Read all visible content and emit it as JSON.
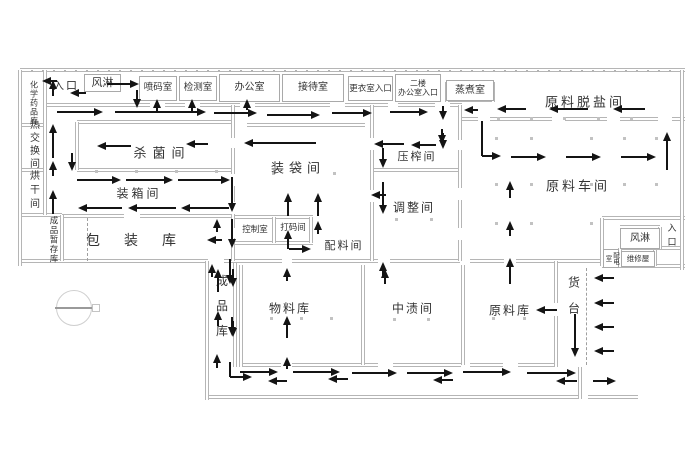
{
  "meta": {
    "bg": "#ffffff",
    "wall_color": "#b5b5b5",
    "arrow_color": "#141414",
    "text_color": "#333333",
    "canvas_width": 700,
    "canvas_height": 466
  },
  "floorplan": {
    "boxed_rooms": [
      {
        "id": "air-shower-top",
        "label": "风淋",
        "x": 84,
        "y": 74,
        "w": 37,
        "h": 18,
        "fs": 11
      },
      {
        "id": "code-spray-room",
        "label": "喷码室",
        "x": 139,
        "y": 76,
        "w": 38,
        "h": 25,
        "fs": 9.5
      },
      {
        "id": "inspection-room",
        "label": "检测室",
        "x": 179,
        "y": 76,
        "w": 38,
        "h": 25,
        "fs": 9.5
      },
      {
        "id": "office",
        "label": "办公室",
        "x": 219,
        "y": 74,
        "w": 61,
        "h": 28,
        "fs": 10
      },
      {
        "id": "reception-room",
        "label": "接待室",
        "x": 282,
        "y": 74,
        "w": 62,
        "h": 28,
        "fs": 10
      },
      {
        "id": "changing-room-entrance",
        "label": "更衣室入口",
        "x": 348,
        "y": 76,
        "w": 45,
        "h": 25,
        "fs": 8.5
      },
      {
        "id": "second-floor-office-entrance",
        "label": "二楼\n办公室入口",
        "x": 395,
        "y": 74,
        "w": 46,
        "h": 28,
        "fs": 8
      },
      {
        "id": "steaming-room",
        "label": "蒸煮室",
        "x": 446,
        "y": 80,
        "w": 48,
        "h": 21,
        "fs": 10
      },
      {
        "id": "air-shower-right",
        "label": "风淋",
        "x": 620,
        "y": 228,
        "w": 40,
        "h": 21,
        "fs": 10
      },
      {
        "id": "power-distribution-room",
        "label": "配电室",
        "x": 603,
        "y": 249,
        "w": 16,
        "h": 19,
        "fs": 6.5,
        "v": true
      },
      {
        "id": "maintenance-room",
        "label": "维修屋",
        "x": 621,
        "y": 251,
        "w": 34,
        "h": 16,
        "fs": 7.5
      }
    ],
    "labels": [
      {
        "id": "entrance-left",
        "label": "入口",
        "x": 66,
        "y": 85,
        "fs": 11,
        "ls": 2
      },
      {
        "id": "chemical-storage",
        "label": "化学药品库",
        "x": 34,
        "y": 103,
        "fs": 8,
        "ls": 1,
        "v": true
      },
      {
        "id": "heat-exchange-room",
        "label": "热交换间",
        "x": 33,
        "y": 145,
        "fs": 10,
        "ls": 3,
        "v": true
      },
      {
        "id": "drying-room",
        "label": "烘干间",
        "x": 33,
        "y": 191,
        "fs": 10,
        "ls": 4,
        "v": true
      },
      {
        "id": "finished-goods-temp-storage",
        "label": "成品暂存库",
        "x": 54,
        "y": 240,
        "fs": 8.5,
        "ls": 1,
        "v": true
      },
      {
        "id": "sterilization-room",
        "label": "杀菌间",
        "x": 162,
        "y": 152,
        "fs": 13,
        "ls": 6
      },
      {
        "id": "packing-box-room",
        "label": "装箱间",
        "x": 139,
        "y": 193,
        "fs": 12,
        "ls": 3
      },
      {
        "id": "packaging-warehouse",
        "label": "包装库",
        "x": 143,
        "y": 240,
        "fs": 14,
        "ls": 24
      },
      {
        "id": "bagging-room",
        "label": "装袋间",
        "x": 298,
        "y": 167,
        "fs": 13,
        "ls": 5
      },
      {
        "id": "control-room",
        "label": "控制室",
        "x": 255,
        "y": 229,
        "fs": 8.5,
        "ls": 0
      },
      {
        "id": "code-printing-room",
        "label": "打码间",
        "x": 293,
        "y": 227,
        "fs": 8.5,
        "ls": 0
      },
      {
        "id": "ingredients-room",
        "label": "配料间",
        "x": 344,
        "y": 245,
        "fs": 11,
        "ls": 2
      },
      {
        "id": "pressing-room",
        "label": "压榨间",
        "x": 417,
        "y": 156,
        "fs": 11,
        "ls": 2
      },
      {
        "id": "adjustment-room",
        "label": "调整间",
        "x": 414,
        "y": 207,
        "fs": 12,
        "ls": 2
      },
      {
        "id": "raw-material-desalting-room",
        "label": "原料脱盐间",
        "x": 585,
        "y": 101,
        "fs": 13,
        "ls": 3
      },
      {
        "id": "raw-material-workshop",
        "label": "原料车间",
        "x": 578,
        "y": 185,
        "fs": 13,
        "ls": 3
      },
      {
        "id": "entrance-right",
        "label": "入口",
        "x": 672,
        "y": 237,
        "fs": 9,
        "ls": 5,
        "v": true
      },
      {
        "id": "finished-goods-warehouse",
        "label": "成品库",
        "x": 222,
        "y": 312,
        "fs": 12,
        "ls": 13,
        "v": true
      },
      {
        "id": "material-warehouse",
        "label": "物料库",
        "x": 290,
        "y": 308,
        "fs": 12,
        "ls": 2
      },
      {
        "id": "mid-pickling-room",
        "label": "中渍间",
        "x": 413,
        "y": 308,
        "fs": 12,
        "ls": 2
      },
      {
        "id": "raw-material-warehouse",
        "label": "原料库",
        "x": 510,
        "y": 310,
        "fs": 12,
        "ls": 2
      },
      {
        "id": "loading-dock",
        "label": "货台",
        "x": 574,
        "y": 302,
        "fs": 12,
        "ls": 14,
        "v": true
      }
    ],
    "walls": [
      [
        20,
        70,
        665,
        "h",
        "hatch"
      ],
      [
        45,
        105,
        105,
        "h"
      ],
      [
        165,
        105,
        20,
        "h"
      ],
      [
        200,
        105,
        40,
        "h"
      ],
      [
        255,
        105,
        75,
        "h"
      ],
      [
        345,
        105,
        43,
        "h"
      ],
      [
        398,
        105,
        37,
        "h"
      ],
      [
        450,
        105,
        12,
        "h"
      ],
      [
        20,
        125,
        25,
        "h"
      ],
      [
        20,
        170,
        25,
        "h"
      ],
      [
        20,
        215,
        42,
        "h"
      ],
      [
        77,
        122,
        158,
        "h"
      ],
      [
        77,
        170,
        158,
        "h"
      ],
      [
        62,
        216,
        62,
        "h"
      ],
      [
        140,
        216,
        95,
        "h"
      ],
      [
        247,
        125,
        118,
        "h"
      ],
      [
        235,
        217,
        78,
        "h"
      ],
      [
        235,
        243,
        78,
        "h"
      ],
      [
        374,
        170,
        86,
        "h"
      ],
      [
        447,
        100,
        48,
        "h"
      ],
      [
        460,
        119,
        18,
        "h"
      ],
      [
        490,
        119,
        62,
        "h"
      ],
      [
        565,
        119,
        42,
        "h"
      ],
      [
        620,
        119,
        38,
        "h"
      ],
      [
        672,
        119,
        13,
        "h"
      ],
      [
        602,
        218,
        83,
        "h"
      ],
      [
        602,
        266,
        83,
        "h"
      ],
      [
        620,
        227,
        40,
        "h"
      ],
      [
        620,
        248,
        63,
        "h"
      ],
      [
        20,
        261,
        188,
        "h"
      ],
      [
        224,
        261,
        58,
        "h"
      ],
      [
        292,
        261,
        86,
        "h"
      ],
      [
        390,
        261,
        70,
        "h"
      ],
      [
        470,
        261,
        34,
        "h"
      ],
      [
        516,
        261,
        86,
        "h"
      ],
      [
        241,
        365,
        40,
        "h"
      ],
      [
        292,
        365,
        86,
        "h"
      ],
      [
        393,
        365,
        68,
        "h"
      ],
      [
        470,
        365,
        33,
        "h"
      ],
      [
        518,
        365,
        38,
        "h"
      ],
      [
        207,
        397,
        373,
        "h"
      ],
      [
        588,
        397,
        50,
        "h"
      ],
      [
        20,
        70,
        196,
        "v"
      ],
      [
        682,
        70,
        200,
        "v"
      ],
      [
        45,
        70,
        145,
        "v"
      ],
      [
        62,
        215,
        46,
        "v"
      ],
      [
        77,
        122,
        48,
        "v"
      ],
      [
        233,
        105,
        33,
        "v"
      ],
      [
        233,
        148,
        26,
        "v"
      ],
      [
        233,
        186,
        16,
        "v"
      ],
      [
        233,
        214,
        14,
        "v"
      ],
      [
        233,
        238,
        23,
        "v"
      ],
      [
        274,
        217,
        26,
        "v"
      ],
      [
        311,
        217,
        26,
        "v"
      ],
      [
        372,
        105,
        33,
        "v"
      ],
      [
        372,
        150,
        40,
        "v"
      ],
      [
        372,
        202,
        59,
        "v"
      ],
      [
        460,
        105,
        35,
        "v"
      ],
      [
        460,
        150,
        38,
        "v"
      ],
      [
        460,
        200,
        28,
        "v"
      ],
      [
        460,
        240,
        21,
        "v"
      ],
      [
        447,
        82,
        20,
        "v"
      ],
      [
        493,
        82,
        20,
        "v"
      ],
      [
        602,
        218,
        48,
        "v"
      ],
      [
        660,
        227,
        22,
        "v"
      ],
      [
        620,
        248,
        18,
        "v"
      ],
      [
        655,
        250,
        16,
        "v"
      ],
      [
        207,
        261,
        139,
        "v"
      ],
      [
        235,
        263,
        104,
        "v"
      ],
      [
        241,
        265,
        102,
        "v"
      ],
      [
        363,
        265,
        100,
        "v"
      ],
      [
        463,
        265,
        100,
        "v"
      ],
      [
        556,
        261,
        42,
        "v"
      ],
      [
        556,
        316,
        51,
        "v"
      ],
      [
        580,
        367,
        32,
        "v"
      ],
      [
        588,
        268,
        97,
        "v",
        "dashed"
      ],
      [
        89,
        218,
        43,
        "v",
        "dashed"
      ]
    ],
    "arrows": [
      [
        53,
        96,
        53,
        80
      ],
      [
        57,
        81,
        42,
        81
      ],
      [
        86,
        93,
        70,
        93
      ],
      [
        107,
        84,
        139,
        84
      ],
      [
        137,
        90,
        137,
        108
      ],
      [
        57,
        112,
        103,
        112
      ],
      [
        115,
        112,
        206,
        112
      ],
      [
        157,
        111,
        157,
        99
      ],
      [
        192,
        111,
        192,
        99
      ],
      [
        214,
        113,
        257,
        113
      ],
      [
        247,
        110,
        247,
        99
      ],
      [
        267,
        115,
        320,
        115
      ],
      [
        332,
        113,
        372,
        113
      ],
      [
        390,
        112,
        428,
        112
      ],
      [
        443,
        106,
        443,
        120
      ],
      [
        478,
        110,
        464,
        110
      ],
      [
        443,
        133,
        443,
        149
      ],
      [
        526,
        109,
        497,
        109
      ],
      [
        588,
        109,
        549,
        109
      ],
      [
        645,
        109,
        613,
        109
      ],
      [
        667,
        170,
        667,
        132
      ],
      [
        482,
        121,
        482,
        156,
        "s"
      ],
      [
        482,
        156,
        501,
        156
      ],
      [
        511,
        157,
        546,
        157
      ],
      [
        566,
        157,
        601,
        157
      ],
      [
        621,
        157,
        656,
        157
      ],
      [
        510,
        198,
        510,
        181
      ],
      [
        510,
        236,
        510,
        221
      ],
      [
        510,
        284,
        510,
        258
      ],
      [
        442,
        129,
        442,
        144
      ],
      [
        436,
        145,
        411,
        145
      ],
      [
        404,
        144,
        374,
        144
      ],
      [
        383,
        148,
        383,
        168
      ],
      [
        386,
        195,
        371,
        195
      ],
      [
        383,
        182,
        383,
        214
      ],
      [
        383,
        277,
        383,
        262
      ],
      [
        316,
        143,
        244,
        143
      ],
      [
        288,
        216,
        288,
        193
      ],
      [
        318,
        216,
        318,
        193
      ],
      [
        318,
        234,
        318,
        221
      ],
      [
        288,
        249,
        288,
        230
      ],
      [
        289,
        249,
        311,
        249
      ],
      [
        131,
        146,
        97,
        146
      ],
      [
        208,
        144,
        186,
        144
      ],
      [
        53,
        158,
        53,
        124
      ],
      [
        53,
        176,
        53,
        161
      ],
      [
        72,
        153,
        72,
        171
      ],
      [
        53,
        214,
        53,
        190
      ],
      [
        77,
        180,
        121,
        180
      ],
      [
        126,
        180,
        173,
        180
      ],
      [
        178,
        180,
        230,
        180
      ],
      [
        122,
        208,
        78,
        208
      ],
      [
        176,
        208,
        128,
        208
      ],
      [
        229,
        208,
        181,
        208
      ],
      [
        232,
        177,
        232,
        212
      ],
      [
        217,
        232,
        217,
        219
      ],
      [
        222,
        240,
        207,
        240
      ],
      [
        232,
        219,
        232,
        248
      ],
      [
        212,
        277,
        212,
        264
      ],
      [
        218,
        292,
        218,
        269
      ],
      [
        230,
        259,
        230,
        284
      ],
      [
        218,
        326,
        218,
        311
      ],
      [
        232,
        317,
        232,
        336
      ],
      [
        217,
        368,
        217,
        354
      ],
      [
        230,
        362,
        230,
        377,
        "s"
      ],
      [
        230,
        377,
        252,
        377
      ],
      [
        240,
        372,
        278,
        372
      ],
      [
        287,
        369,
        287,
        357
      ],
      [
        287,
        381,
        268,
        381
      ],
      [
        293,
        372,
        340,
        372
      ],
      [
        348,
        379,
        328,
        379
      ],
      [
        352,
        373,
        397,
        373
      ],
      [
        407,
        373,
        453,
        373
      ],
      [
        453,
        380,
        433,
        380
      ],
      [
        463,
        372,
        511,
        372
      ],
      [
        527,
        373,
        576,
        373
      ],
      [
        577,
        381,
        556,
        381
      ],
      [
        593,
        381,
        616,
        381
      ],
      [
        287,
        281,
        287,
        268
      ],
      [
        287,
        338,
        287,
        316
      ],
      [
        385,
        284,
        385,
        269
      ],
      [
        233,
        269,
        233,
        287
      ],
      [
        233,
        321,
        233,
        337
      ],
      [
        557,
        310,
        536,
        310
      ],
      [
        575,
        314,
        575,
        357
      ],
      [
        614,
        278,
        594,
        278
      ],
      [
        614,
        303,
        594,
        303
      ],
      [
        614,
        327,
        594,
        327
      ],
      [
        614,
        351,
        594,
        351
      ]
    ],
    "dots": [
      [
        95,
        170
      ],
      [
        135,
        170
      ],
      [
        175,
        170
      ],
      [
        215,
        170
      ],
      [
        272,
        172
      ],
      [
        333,
        172
      ],
      [
        395,
        218
      ],
      [
        430,
        218
      ],
      [
        497,
        117
      ],
      [
        530,
        117
      ],
      [
        563,
        117
      ],
      [
        597,
        117
      ],
      [
        630,
        117
      ],
      [
        495,
        137
      ],
      [
        530,
        137
      ],
      [
        590,
        137
      ],
      [
        623,
        137
      ],
      [
        655,
        137
      ],
      [
        495,
        183
      ],
      [
        530,
        183
      ],
      [
        590,
        183
      ],
      [
        623,
        183
      ],
      [
        655,
        183
      ],
      [
        495,
        222
      ],
      [
        530,
        222
      ],
      [
        590,
        222
      ],
      [
        270,
        317
      ],
      [
        300,
        317
      ],
      [
        330,
        317
      ],
      [
        393,
        318
      ],
      [
        427,
        318
      ],
      [
        492,
        317
      ],
      [
        523,
        317
      ]
    ],
    "compass": {
      "cx": 73,
      "cy": 307,
      "r": 17
    }
  }
}
